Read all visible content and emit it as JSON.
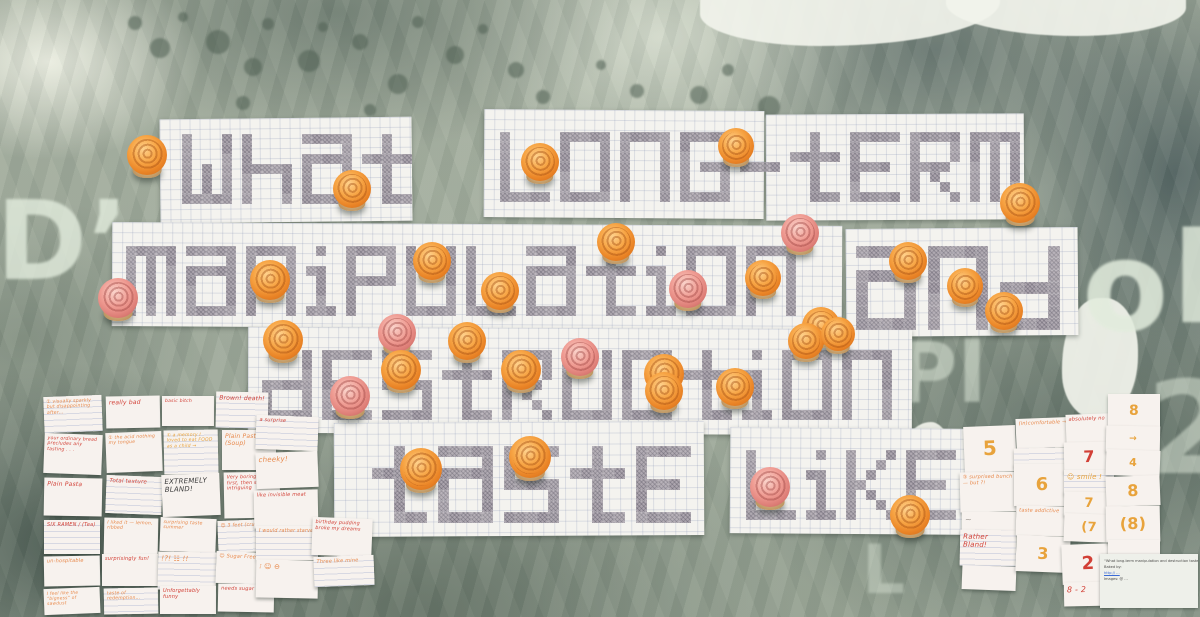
{
  "caption": "Photograph of a gallery wall: pencil-shaded pixel lettering on graph paper reading “what long-term manipulation and destruction taste like”, covered with orange and pink mini cupcakes, pinned over tie-dye fabric with stencilled letters; handwritten tasting-note cards on the left and numeric rating cards on the right.",
  "pixel_text": {
    "full_phrase": "what long-term manipulation and destruction taste like",
    "rows": [
      "what long-term",
      "manipulation and",
      "destruction",
      "taste like"
    ]
  },
  "colors": {
    "icing_orange": "#f7a545",
    "icing_pink": "#ef9b92",
    "paper": "#f4f3ef",
    "pencil": "#aba4ad",
    "fabric_teal": "#5c7069",
    "fabric_cream": "#e6e9da",
    "ink": {
      "red": "#d23f35",
      "orange": "#e8884a",
      "amber": "#e8a33c",
      "dark": "#3a3a3a",
      "gray": "#9a948e",
      "blue": "#3a6bd6"
    }
  },
  "words": [
    {
      "text": "what",
      "x": 182,
      "y": 134,
      "cell": 10
    },
    {
      "text": "long-term",
      "x": 500,
      "y": 132,
      "cell": 10
    },
    {
      "text": "manipulation",
      "x": 126,
      "y": 246,
      "cell": 10
    },
    {
      "text": "and",
      "x": 856,
      "y": 246,
      "cell": 12
    },
    {
      "text": "destruction",
      "x": 262,
      "y": 350,
      "cell": 10
    },
    {
      "text": "taste",
      "x": 372,
      "y": 446,
      "cell": 11
    },
    {
      "text": "like",
      "x": 746,
      "y": 450,
      "cell": 10
    }
  ],
  "sheets": [
    [
      160,
      118,
      252,
      104,
      -0.6,
      10
    ],
    [
      484,
      110,
      280,
      108,
      0.4,
      10
    ],
    [
      766,
      114,
      258,
      106,
      -0.3,
      10
    ],
    [
      112,
      224,
      730,
      104,
      0.3,
      10
    ],
    [
      846,
      228,
      232,
      108,
      -0.5,
      12
    ],
    [
      248,
      328,
      664,
      106,
      0.2,
      10
    ],
    [
      334,
      422,
      370,
      114,
      -0.3,
      11
    ],
    [
      730,
      428,
      244,
      106,
      0.4,
      10
    ]
  ],
  "cupcakes": [
    [
      147,
      155,
      "o",
      40
    ],
    [
      352,
      189,
      "o",
      38
    ],
    [
      540,
      162,
      "o",
      38
    ],
    [
      736,
      146,
      "o",
      36
    ],
    [
      1020,
      203,
      "o",
      40
    ],
    [
      800,
      233,
      "p",
      38
    ],
    [
      616,
      242,
      "o",
      38
    ],
    [
      432,
      261,
      "o",
      38
    ],
    [
      270,
      280,
      "o",
      40
    ],
    [
      118,
      298,
      "p",
      40
    ],
    [
      908,
      261,
      "o",
      38
    ],
    [
      763,
      278,
      "o",
      36
    ],
    [
      965,
      286,
      "o",
      36
    ],
    [
      1004,
      311,
      "o",
      38
    ],
    [
      283,
      340,
      "o",
      40
    ],
    [
      397,
      333,
      "p",
      38
    ],
    [
      500,
      291,
      "o",
      38
    ],
    [
      688,
      289,
      "p",
      38
    ],
    [
      821,
      326,
      "o",
      38
    ],
    [
      467,
      341,
      "o",
      38
    ],
    [
      401,
      370,
      "o",
      40
    ],
    [
      350,
      396,
      "p",
      40
    ],
    [
      521,
      370,
      "o",
      40
    ],
    [
      580,
      357,
      "p",
      38
    ],
    [
      664,
      374,
      "o",
      40
    ],
    [
      735,
      387,
      "o",
      38
    ],
    [
      806,
      341,
      "o",
      36
    ],
    [
      838,
      334,
      "o",
      34
    ],
    [
      421,
      469,
      "o",
      42
    ],
    [
      530,
      457,
      "o",
      42
    ],
    [
      664,
      391,
      "o",
      38
    ],
    [
      770,
      487,
      "p",
      40
    ],
    [
      910,
      515,
      "o",
      40
    ]
  ],
  "notes_left": [
    [
      44,
      396,
      58,
      36,
      "① visually sparkly but disappointing after…",
      "orange",
      4.6
    ],
    [
      106,
      396,
      54,
      32,
      "really bad",
      "red",
      6
    ],
    [
      162,
      396,
      52,
      30,
      "basic bitch",
      "red",
      4.6
    ],
    [
      216,
      392,
      52,
      36,
      "Brown! death!",
      "red",
      6
    ],
    [
      44,
      434,
      58,
      40,
      "your ordinary bread precludes any tasting . . .",
      "red",
      4.6
    ],
    [
      106,
      432,
      56,
      40,
      "① the acid nothing my tongue",
      "orange",
      4.6
    ],
    [
      164,
      430,
      54,
      44,
      "① a memory I loved to eat FOOD as a child →",
      "amber",
      4.6
    ],
    [
      222,
      430,
      54,
      40,
      "Plain Pasta (Soup)",
      "orange",
      6
    ],
    [
      44,
      478,
      58,
      38,
      "Plain Pasta",
      "red",
      6
    ],
    [
      106,
      476,
      56,
      38,
      "Total texture",
      "red",
      5.5
    ],
    [
      162,
      474,
      58,
      42,
      "EXTREMELY BLAND!",
      "dark",
      7
    ],
    [
      224,
      472,
      56,
      46,
      "Very boring at first, then slightly intriguing",
      "red",
      4.8
    ],
    [
      44,
      520,
      56,
      34,
      "SIX RAMEN / (Tea)",
      "red",
      5
    ],
    [
      104,
      518,
      54,
      38,
      "I liked it — lemon, ribbed",
      "orange",
      4.6
    ],
    [
      160,
      518,
      56,
      34,
      "surprising taste summer",
      "orange",
      4.6
    ],
    [
      218,
      520,
      56,
      32,
      "☺ 3 feet (crunchy)",
      "orange",
      4.8
    ],
    [
      44,
      556,
      56,
      30,
      "un-hospitable",
      "orange",
      5
    ],
    [
      102,
      554,
      56,
      32,
      "surprisingly fun!",
      "red",
      5
    ],
    [
      158,
      552,
      58,
      38,
      "!?! ☷ !!",
      "orange",
      7
    ],
    [
      216,
      552,
      56,
      32,
      "☺ Sugar Free",
      "orange",
      5
    ],
    [
      44,
      588,
      56,
      26,
      "I feel like the “bigness” of sawdust",
      "orange",
      4.4
    ],
    [
      104,
      588,
      54,
      26,
      "taste of redemption…",
      "orange",
      4.6
    ],
    [
      160,
      586,
      56,
      28,
      "Unforgettably funny",
      "red",
      5
    ],
    [
      218,
      584,
      56,
      28,
      "needs sugar ☺",
      "red",
      5
    ],
    [
      256,
      416,
      62,
      34,
      "a surprise",
      "red",
      5
    ],
    [
      256,
      452,
      62,
      36,
      "cheeky!",
      "orange",
      7
    ],
    [
      254,
      490,
      64,
      38,
      "like invisible meat",
      "red",
      5
    ],
    [
      256,
      526,
      62,
      34,
      "I would rather starve",
      "orange",
      4.8
    ],
    [
      256,
      560,
      62,
      38,
      "⁝ ☺ ⊖",
      "orange",
      7
    ],
    [
      312,
      518,
      60,
      38,
      "birthday pudding broke my dreams",
      "red",
      4.8
    ],
    [
      314,
      556,
      60,
      30,
      "Three like mine",
      "orange",
      5
    ]
  ],
  "cards_right": [
    [
      964,
      426,
      52,
      46,
      "5",
      "amber",
      20
    ],
    [
      960,
      472,
      56,
      40,
      "③ surprised bunch — but ?!",
      "orange",
      5
    ],
    [
      962,
      512,
      54,
      20,
      "~",
      "gray",
      8
    ],
    [
      960,
      530,
      56,
      36,
      "Rather Bland!",
      "red",
      7
    ],
    [
      962,
      566,
      54,
      24,
      "",
      "gray",
      5
    ],
    [
      1016,
      418,
      54,
      30,
      "(in)comfortable →",
      "orange",
      5
    ],
    [
      1014,
      448,
      56,
      18,
      "",
      "gray",
      5
    ],
    [
      1014,
      464,
      56,
      42,
      "6",
      "amber",
      18
    ],
    [
      1016,
      506,
      54,
      30,
      "taste addictive",
      "orange",
      5
    ],
    [
      1016,
      536,
      54,
      36,
      "3",
      "amber",
      16
    ],
    [
      1066,
      414,
      48,
      30,
      "absolutely no",
      "red",
      5
    ],
    [
      1064,
      442,
      50,
      30,
      "7",
      "red",
      16
    ],
    [
      1064,
      470,
      50,
      24,
      "☺ smile !",
      "amber",
      7
    ],
    [
      1064,
      492,
      50,
      24,
      "7",
      "amber",
      13
    ],
    [
      1064,
      514,
      50,
      28,
      "(7",
      "amber",
      13
    ],
    [
      1062,
      544,
      52,
      40,
      "2",
      "red",
      18
    ],
    [
      1064,
      582,
      50,
      24,
      "8 - 2",
      "red",
      8
    ],
    [
      1108,
      394,
      52,
      34,
      "8",
      "amber",
      14
    ],
    [
      1106,
      426,
      54,
      26,
      "→",
      "amber",
      9
    ],
    [
      1106,
      450,
      54,
      26,
      "4",
      "amber",
      11
    ],
    [
      1106,
      476,
      54,
      30,
      "8",
      "amber",
      16
    ],
    [
      1106,
      506,
      54,
      36,
      "(8)",
      "amber",
      16
    ],
    [
      1108,
      540,
      52,
      26,
      "",
      "gray",
      5
    ]
  ],
  "plaque": {
    "x": 1100,
    "y": 554,
    "w": 98,
    "h": 54,
    "lines": [
      {
        "text": "“What long-term manipulation and destruction taste like” (… cupcakes, part)",
        "link": false
      },
      {
        "text": "Baked by:",
        "link": false
      },
      {
        "text": "http:// …",
        "link": true
      },
      {
        "text": "Images: @ …",
        "link": false
      }
    ]
  },
  "stencils": [
    {
      "char": "D’",
      "x": -4,
      "y": 192,
      "size": 110,
      "opacity": 0.8
    },
    {
      "char": "Pl",
      "x": 896,
      "y": 336,
      "size": 84,
      "opacity": 0.5
    },
    {
      "char": "o",
      "x": 1082,
      "y": 230,
      "size": 126,
      "opacity": 0.85
    },
    {
      "char": "b",
      "x": 1172,
      "y": 222,
      "size": 126,
      "opacity": 0.8
    },
    {
      "char": "2",
      "x": 1146,
      "y": 372,
      "size": 128,
      "opacity": 0.5
    },
    {
      "char": "L",
      "x": 862,
      "y": 540,
      "size": 68,
      "opacity": 0.4
    }
  ]
}
